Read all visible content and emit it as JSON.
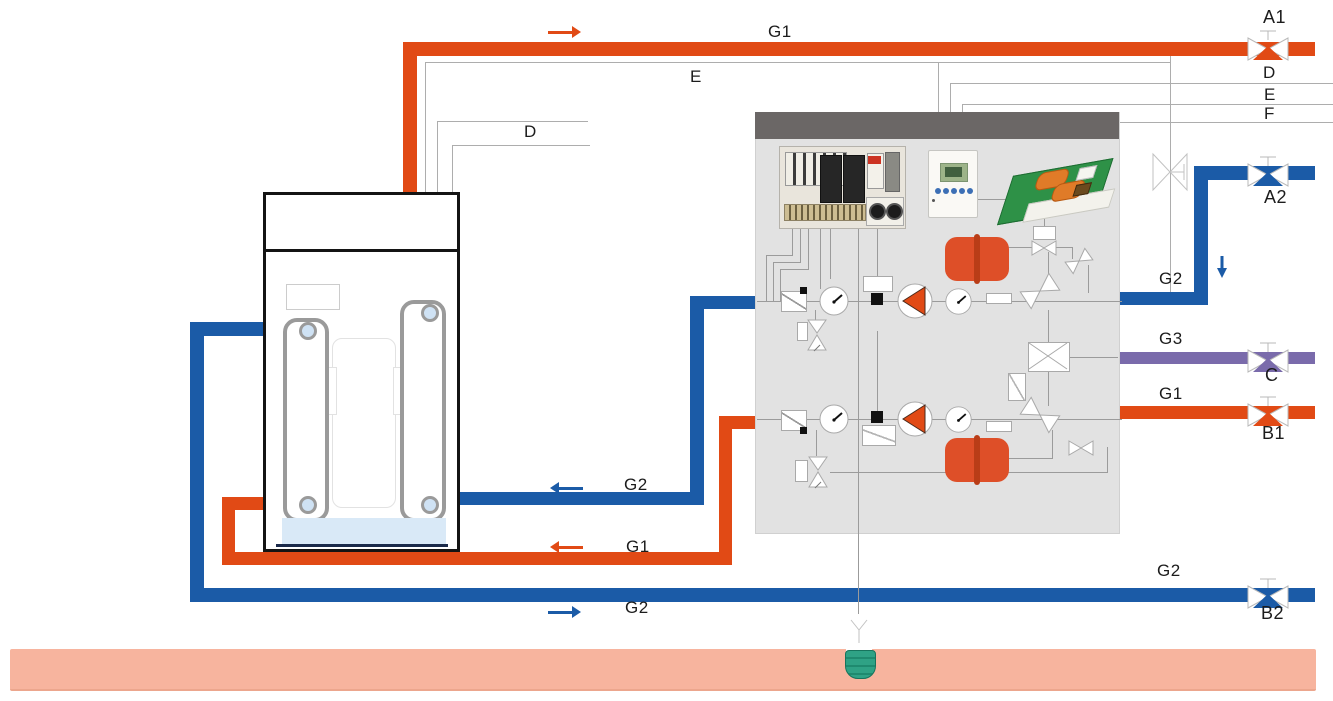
{
  "diagram": {
    "type": "heat-pump water heating piping-and-instrumentation schematic",
    "labels": {
      "g1_top": "G1",
      "e_left": "E",
      "d_left": "D",
      "a1": "A1",
      "d_right": "D",
      "e_right": "E",
      "f_right": "F",
      "a2": "A2",
      "g2_right": "G2",
      "g3_right": "G3",
      "c": "C",
      "g1_right": "G1",
      "b1": "B1",
      "g2_bottom_right": "G2",
      "b2": "B2",
      "g2_mid": "G2",
      "g1_mid": "G1",
      "g2_bottom": "G2"
    },
    "colors": {
      "hot_pipe": "#E14A15",
      "cold_pipe": "#1B5BA7",
      "mixed_pipe": "#7A6BAB",
      "ground_band": "#F7B49E",
      "panel_body": "#E2E2E2",
      "panel_header": "#6B6766",
      "ground_sensor": "#2FA285",
      "tank_water": "#D9E9F7"
    },
    "icons": {
      "valve-icon": "bowtie gate valve with stem",
      "motorized-valve-icon": "outlined bowtie valve with side stem",
      "pump-icon": "circle with left-pointing triangle",
      "gauge-icon": "round dial with needle",
      "filter-icon": "square with diagonal",
      "check-valve-icon": "tilted bowtie",
      "safety-valve-icon": "vertical bowtie with drain",
      "expansion-tank-icon": "orange cylinder",
      "ground-probe-icon": "teal capsule probe",
      "flow-arrow-icon": "direction arrow"
    }
  }
}
